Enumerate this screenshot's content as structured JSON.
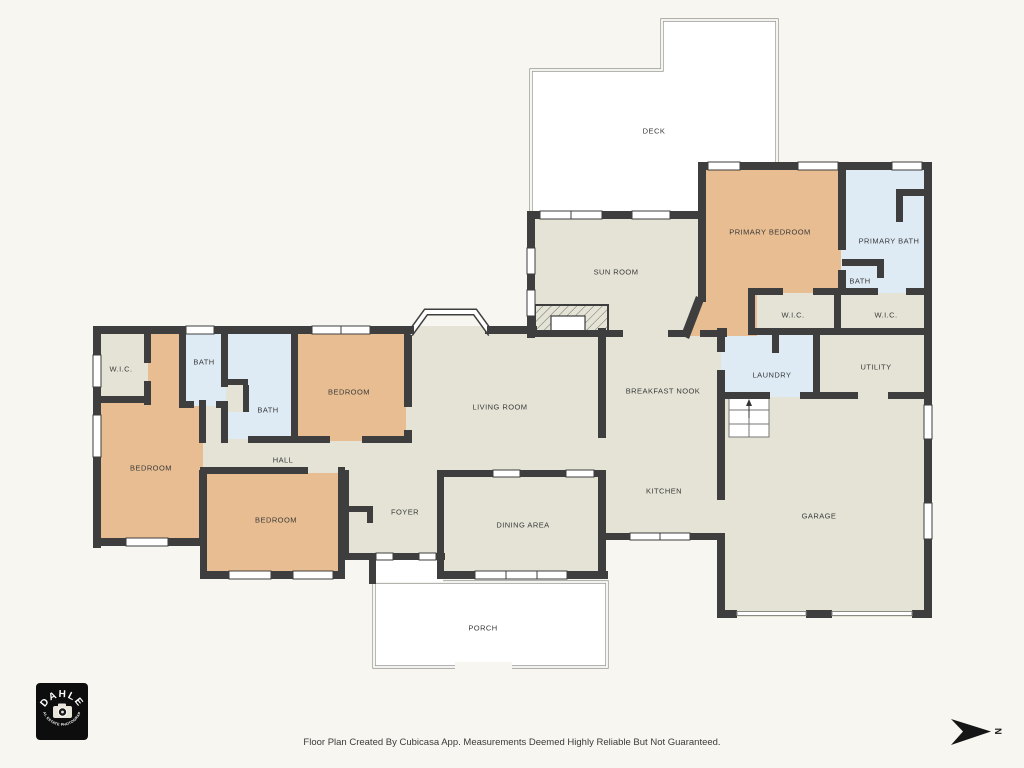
{
  "palette": {
    "background": "#f7f6f1",
    "wall": "#3f3e3e",
    "floor": "#e4e3d6",
    "bedroom": "#e8bd92",
    "bath": "#deebf5",
    "outdoor": "#ffffff",
    "outline": "#9b9b93",
    "text": "#3a3a3a",
    "logo_bg": "#0d0d0d",
    "logo_text": "#ffffff"
  },
  "rooms": {
    "deck": {
      "label": "DECK"
    },
    "sun_room": {
      "label": "SUN ROOM"
    },
    "primary_bedroom": {
      "label": "PRIMARY BEDROOM"
    },
    "primary_bath": {
      "label": "PRIMARY BATH"
    },
    "primary_bath_wc": {
      "label": "BATH"
    },
    "primary_wic_1": {
      "label": "W.I.C."
    },
    "primary_wic_2": {
      "label": "W.I.C."
    },
    "laundry": {
      "label": "LAUNDRY"
    },
    "utility": {
      "label": "UTILITY"
    },
    "breakfast_nook": {
      "label": "BREAKFAST NOOK"
    },
    "kitchen": {
      "label": "KITCHEN"
    },
    "garage": {
      "label": "GARAGE"
    },
    "living_room": {
      "label": "LIVING ROOM"
    },
    "hall": {
      "label": "HALL"
    },
    "foyer": {
      "label": "FOYER"
    },
    "dining_area": {
      "label": "DINING AREA"
    },
    "porch": {
      "label": "PORCH"
    },
    "wic_left": {
      "label": "W.I.C."
    },
    "bath_hall_upper": {
      "label": "BATH"
    },
    "bath_hall_lower": {
      "label": "BATH"
    },
    "bedroom_upper": {
      "label": "BEDROOM"
    },
    "bedroom_left": {
      "label": "BEDROOM"
    },
    "bedroom_lower": {
      "label": "BEDROOM"
    }
  },
  "footer": {
    "disclaimer": "Floor Plan Created By Cubicasa App. Measurements Deemed Highly Reliable But Not Guaranteed."
  },
  "logo": {
    "brand": "DAHLE",
    "tagline": "REAL ESTATE PHOTOGRAPHY"
  },
  "compass": {
    "north_label": "N"
  }
}
